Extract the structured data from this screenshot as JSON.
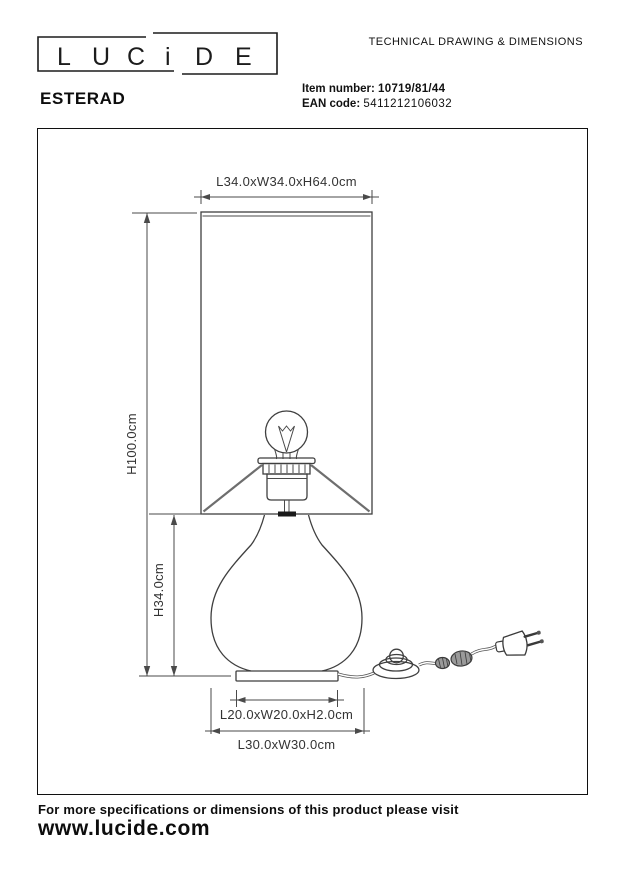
{
  "brand": {
    "logo_letters": [
      "L",
      "U",
      "C",
      "i",
      "D",
      "E"
    ]
  },
  "header": {
    "doc_title": "TECHNICAL DRAWING & DIMENSIONS",
    "product_name": "ESTERAD",
    "item_number_label": "Item number:",
    "item_number": "10719/81/44",
    "ean_label": "EAN code",
    "ean": "5411212106032"
  },
  "drawing": {
    "shade_dimensions": "L34.0xW34.0xH64.0cm",
    "total_height": "H100.0cm",
    "body_height": "H34.0cm",
    "base_top_dimensions": "L20.0xW20.0xH2.0cm",
    "base_dimensions": "L30.0xW30.0cm"
  },
  "footer": {
    "note": "For more specifications or dimensions of this product please visit",
    "website": "www.lucide.com"
  },
  "colors": {
    "ink": "#1a1a1a",
    "drawing_line": "#3f3f3f",
    "dim_text": "#333333"
  }
}
